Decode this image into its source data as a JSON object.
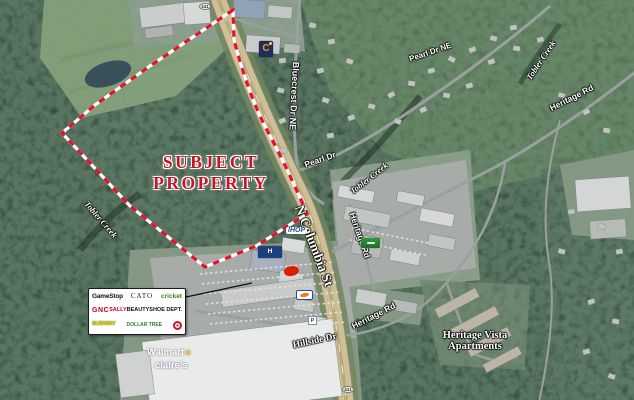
{
  "map": {
    "subject_property": {
      "line1": "SUBJECT",
      "line2": "PROPERTY"
    },
    "road_labels": {
      "n_columbia_st": "N Columbia St",
      "bluecrest_dr": "Bluecrest Dr NE",
      "pearl_dr": "Pearl Dr",
      "pearl_dr_ne": "Pearl Dr NE",
      "tobler_creek": "Tobler Creek",
      "heritage_rd": "Heritage Rd",
      "hillside_dr": "Hillside Dr",
      "route_number": "441"
    },
    "places": {
      "heritage_vista_line1": "Heritage Vista",
      "heritage_vista_line2": "Apartments"
    },
    "tenant_box": {
      "tenants": [
        {
          "label": "GameStop"
        },
        {
          "label": "CATO"
        },
        {
          "label": "cricket"
        },
        {
          "label": "GNC"
        },
        {
          "label": "SALLY",
          "label2": "BEAUTY"
        },
        {
          "label": "SHOE DEPT."
        },
        {
          "label": "SUBWAY"
        },
        {
          "label": "DOLLAR TREE"
        }
      ]
    },
    "store_logos": {
      "walmart": "Walmart",
      "walmart_spark": "✳",
      "claires": "claire's",
      "ihop": "IHOP",
      "hampton_initial": "H",
      "comfort_initial": "C",
      "parcel_initial": "P"
    },
    "colors": {
      "boundary_red": "#e8112d",
      "subject_text_red": "#c81425",
      "walmart_spark_yellow": "#ffc220"
    }
  }
}
